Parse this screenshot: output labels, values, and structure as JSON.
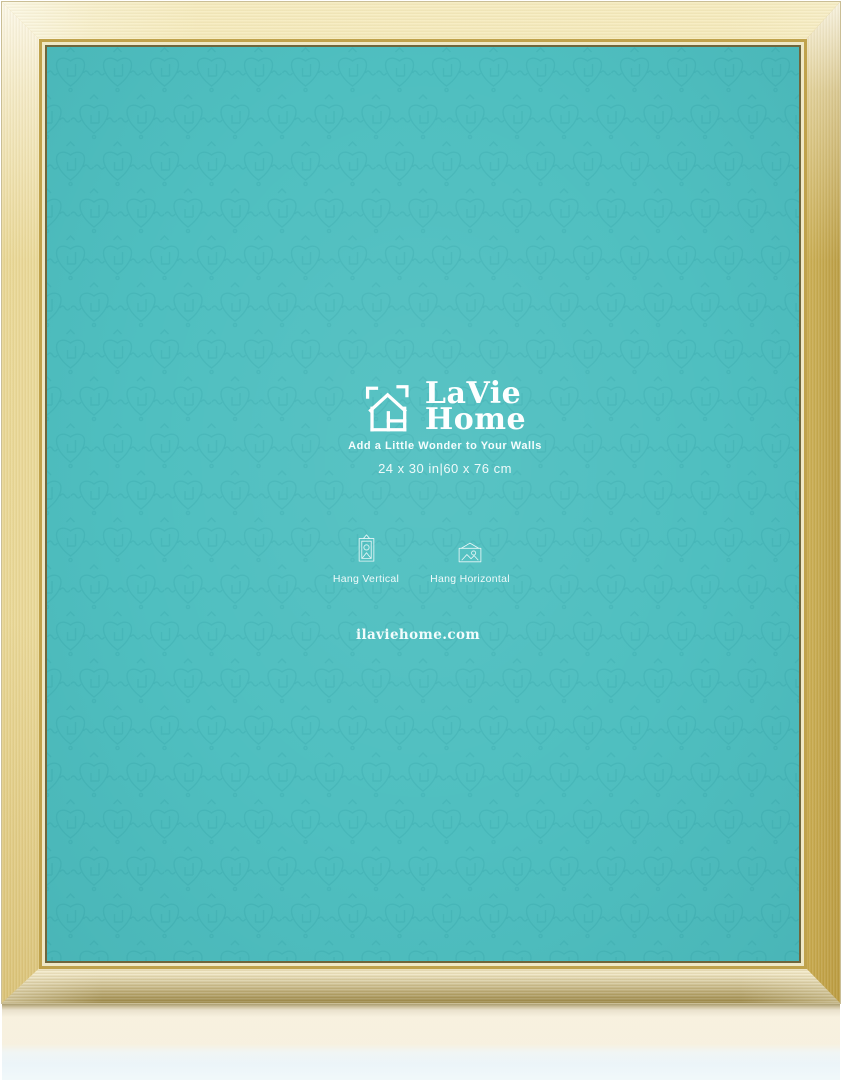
{
  "brand": {
    "name_line1": "LaVie",
    "name_line2": "Home",
    "tagline": "Add a Little Wonder to Your Walls"
  },
  "size_label": "24 x 30 in|60 x 76 cm",
  "hang_options": [
    {
      "label": "Hang Vertical"
    },
    {
      "label": "Hang Horizontal"
    }
  ],
  "website": "ilaviehome.com",
  "colors": {
    "board_teal": "#4fbfc0",
    "pattern_teal": "#1f8e93",
    "frame_cream": "#f6efd0",
    "frame_gold": "#e7cd7a",
    "frame_gold_deep": "#c9a23c",
    "text_white": "#ffffff"
  }
}
